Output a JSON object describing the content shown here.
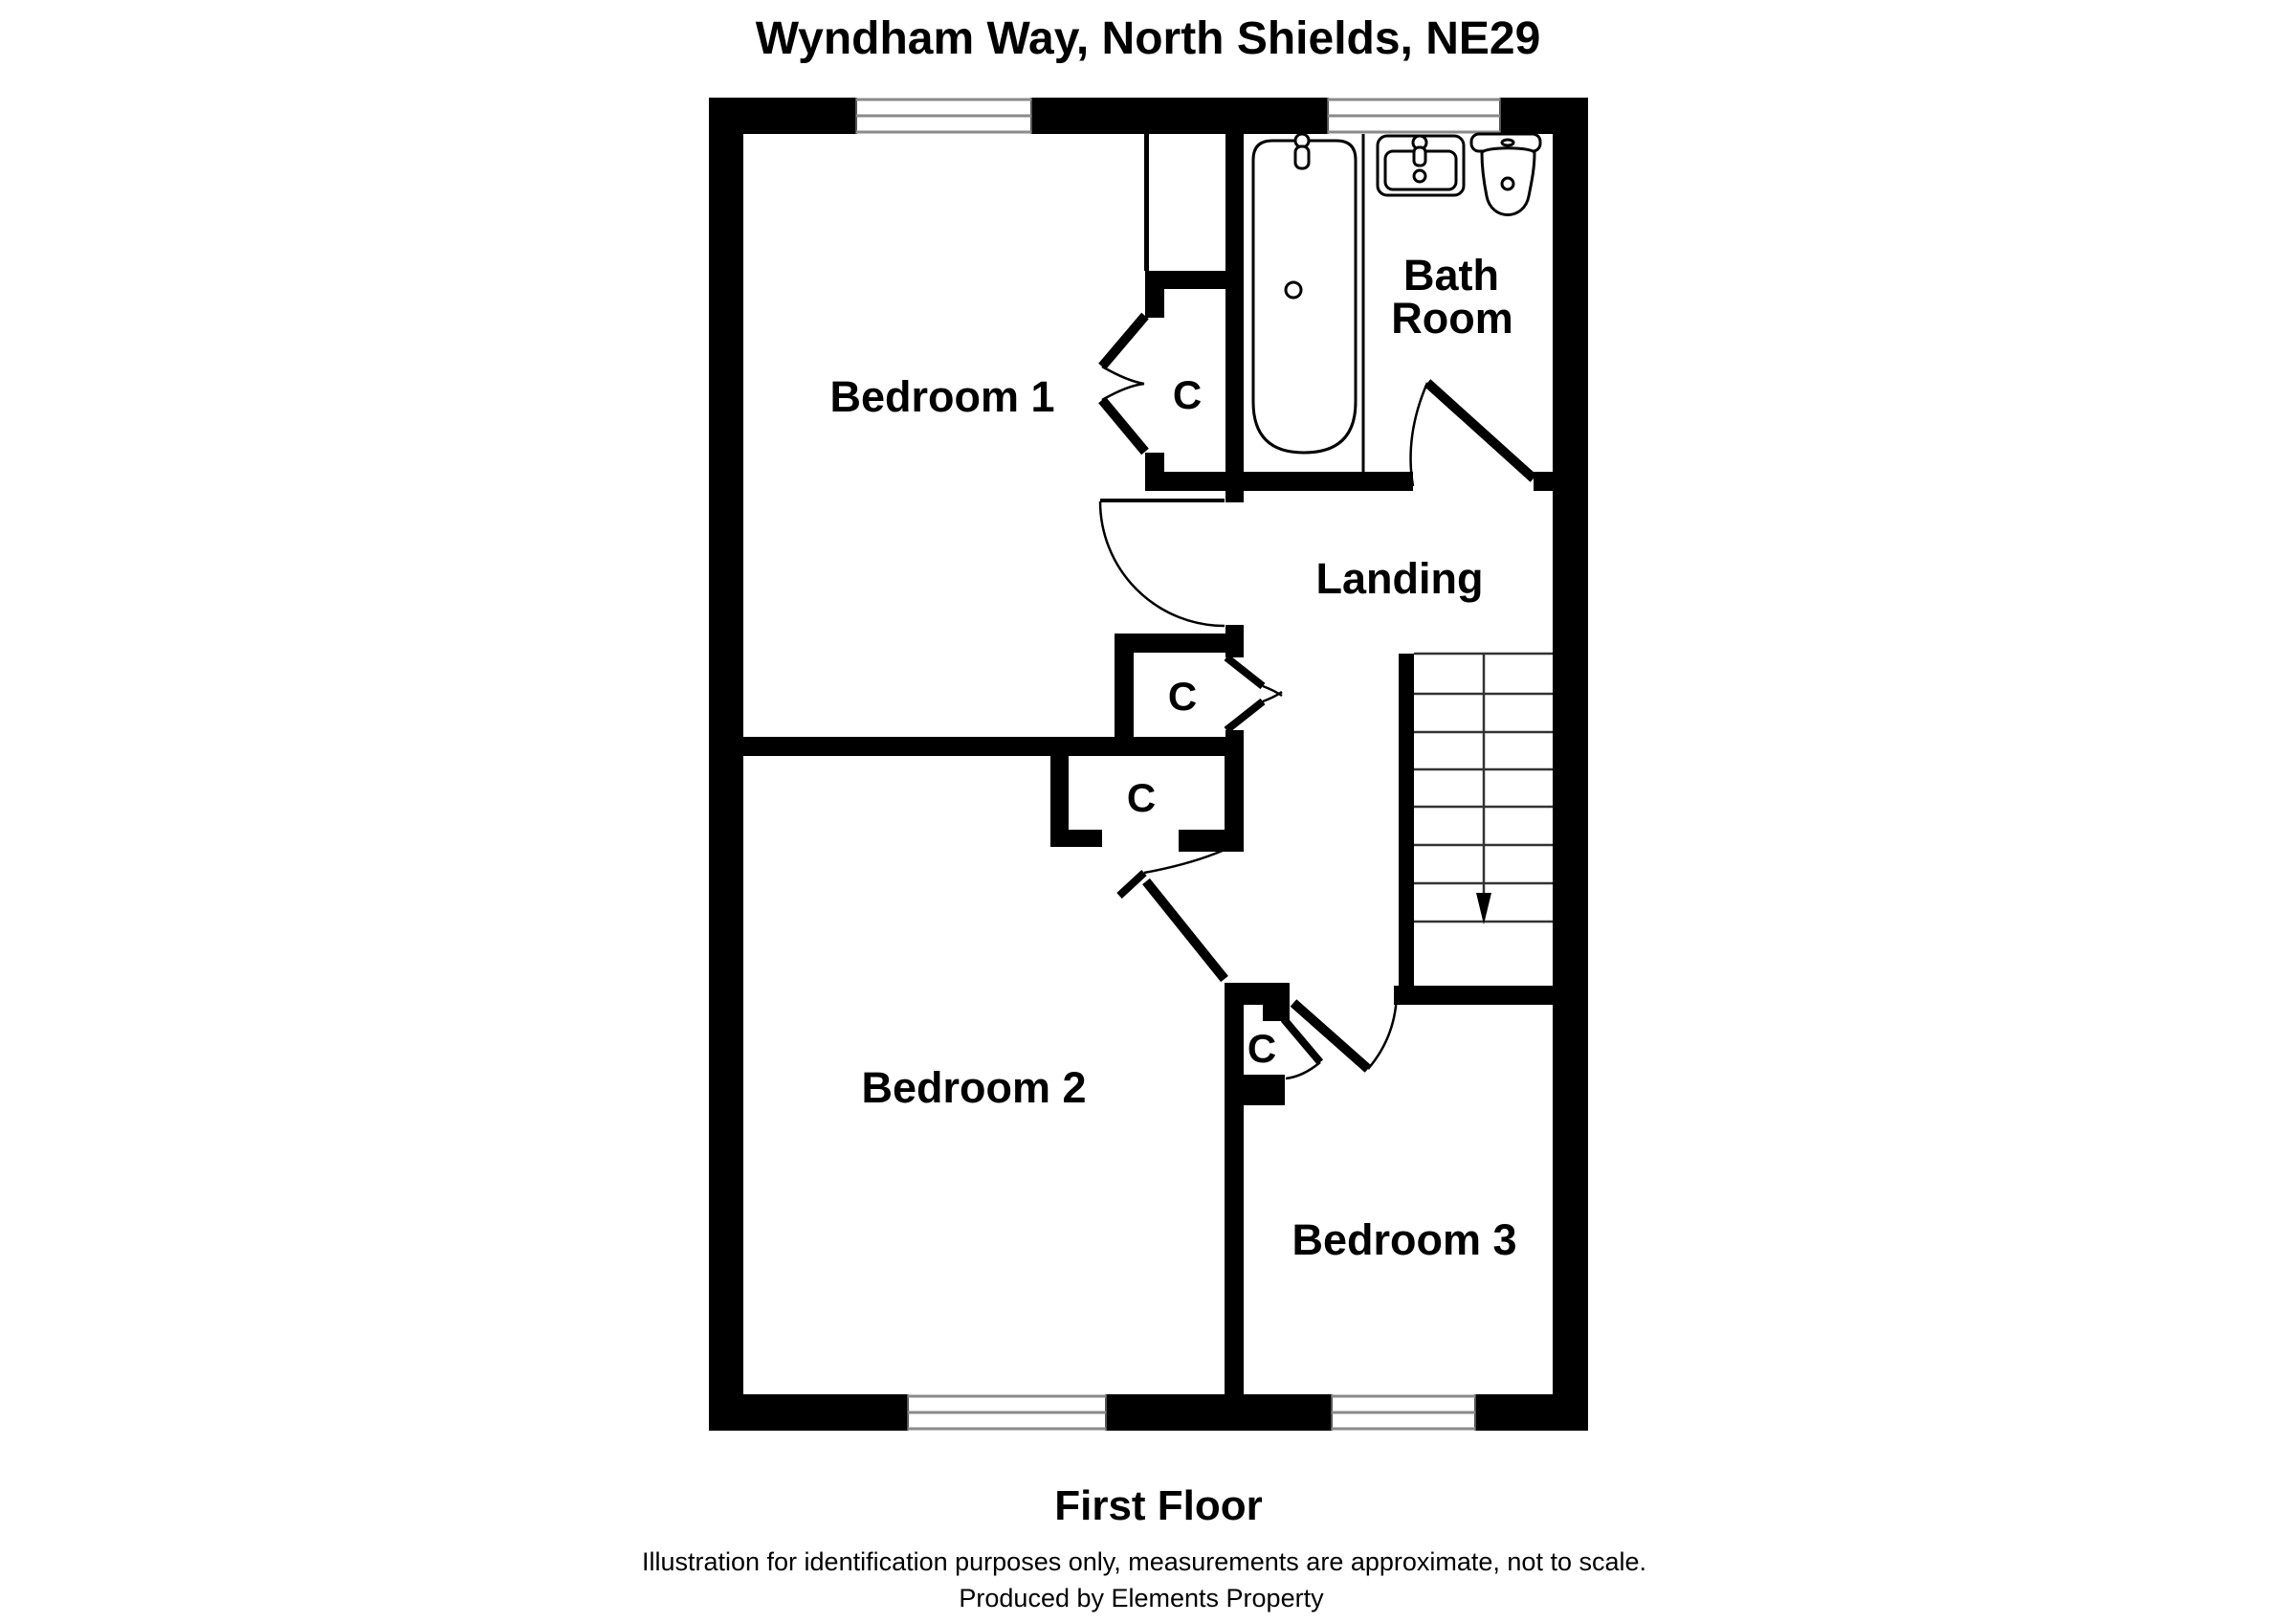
{
  "title": "Wyndham Way, North Shields, NE29",
  "rooms": {
    "bedroom1": {
      "label": "Bedroom 1"
    },
    "bathroom": {
      "line1": "Bath",
      "line2": "Room"
    },
    "landing": {
      "label": "Landing"
    },
    "bedroom2": {
      "label": "Bedroom 2"
    },
    "bedroom3": {
      "label": "Bedroom 3"
    }
  },
  "closets": [
    {
      "label": "C"
    },
    {
      "label": "C"
    },
    {
      "label": "C"
    },
    {
      "label": "C"
    }
  ],
  "footer": {
    "floor_label": "First Floor",
    "disclaimer": "Illustration for identification purposes only, measurements are approximate, not to scale.",
    "produced_by": "Produced by Elements Property"
  },
  "colors": {
    "wall": "#000000",
    "background": "#ffffff",
    "window_line": "#8a8a8a"
  }
}
